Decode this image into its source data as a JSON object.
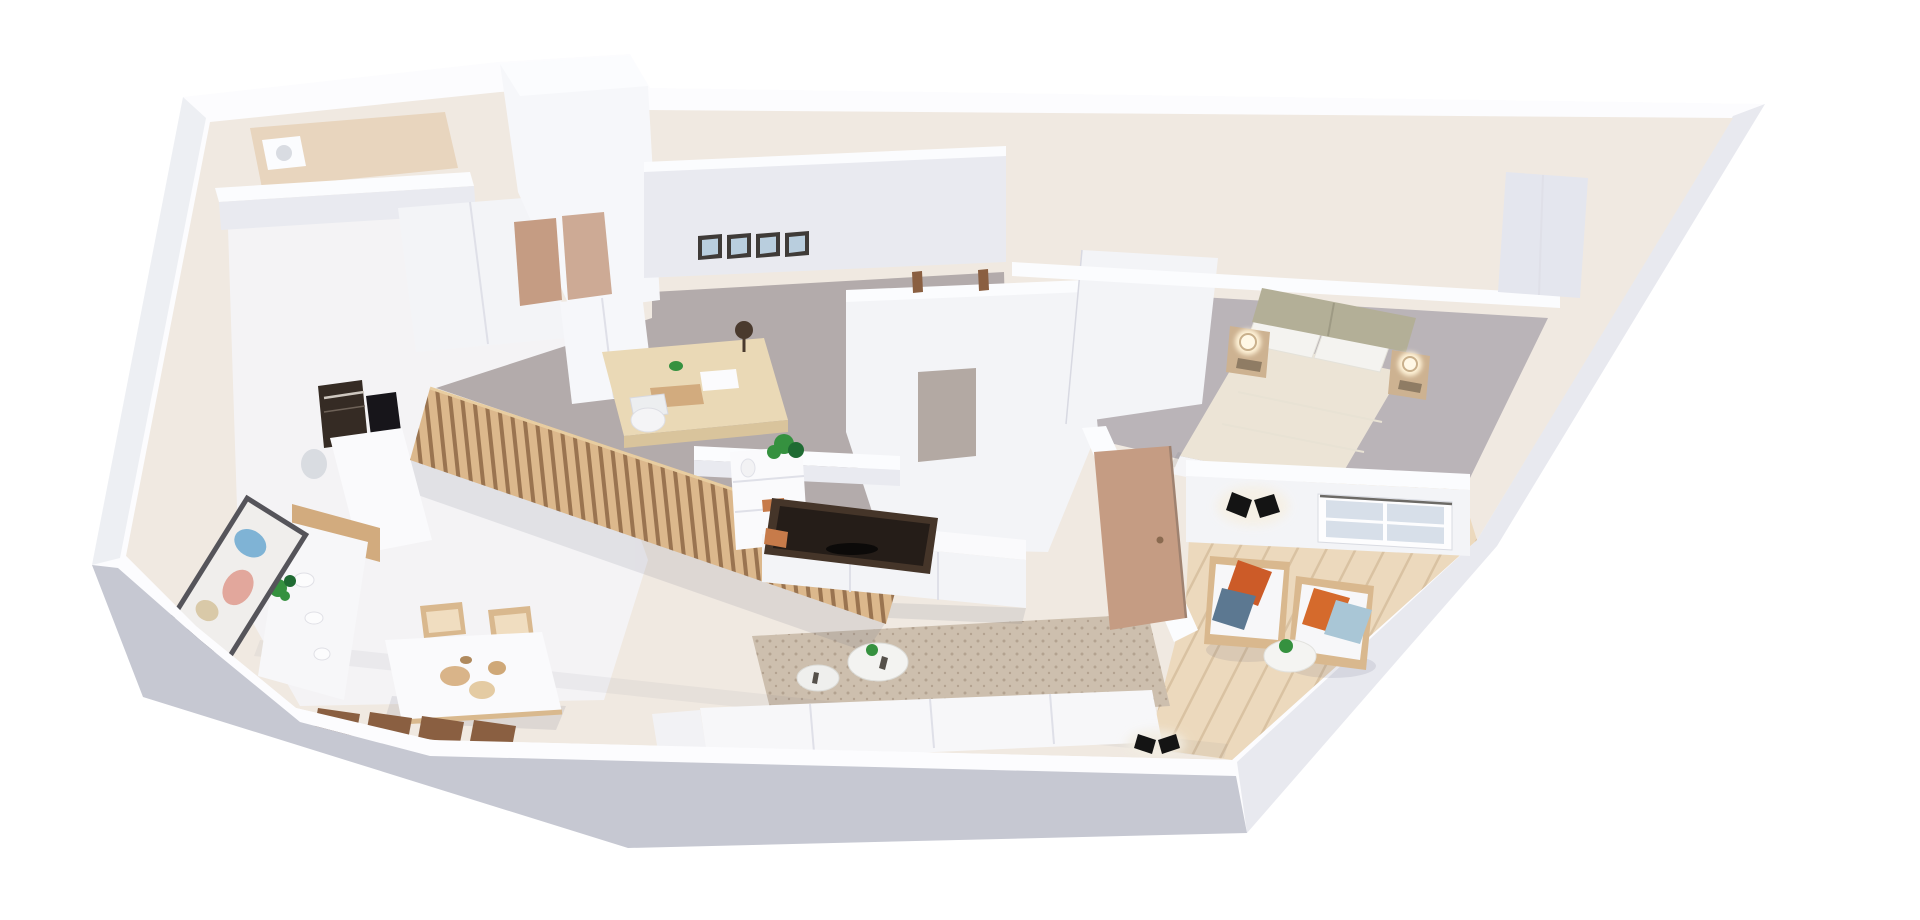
{
  "scene": {
    "type": "3d-floor-plan-render",
    "view": "isometric-top-down",
    "background": "plain white, no text or UI chrome",
    "description": "Photorealistic 3D render of a one-bedroom apartment floor plan seen from above at an angle; white cut walls, wedge-shaped footprint widening to the right",
    "rooms": [
      {
        "id": "bathroom",
        "label": "Bathroom (top-left)",
        "furniture": [
          "washer unit"
        ]
      },
      {
        "id": "kitchen-dining",
        "label": "Kitchen and dining area",
        "furniture": [
          "white cabinet columns",
          "built-in dark oven",
          "black cooktop",
          "marble counters",
          "wood plinth",
          "glass vase",
          "framed wall artwork",
          "potted plant",
          "white bowls",
          "dining table",
          "two light wood chairs",
          "four dark wood chairs"
        ]
      },
      {
        "id": "study",
        "label": "Study / office",
        "furniture": [
          "white wardrobes",
          "four framed wall pictures",
          "desk with lamp and papers",
          "white desk chair",
          "vertical wood slat partition",
          "white shelf unit with monstera plant and books"
        ]
      },
      {
        "id": "living-room",
        "label": "Living room",
        "furniture": [
          "white TV console",
          "dark TV panel",
          "speckled beige rug",
          "large round coffee table",
          "small round coffee table",
          "white sofa"
        ]
      },
      {
        "id": "hallway",
        "label": "Hallway",
        "furniture": [
          "open wood door",
          "shadowed doorway",
          "door knobs on wall top"
        ]
      },
      {
        "id": "bedroom",
        "label": "Bedroom",
        "furniture": [
          "double bed with sage upholstered headboard",
          "two white pillows",
          "cream duvet",
          "floating wood nightstand left with glowing lamp",
          "floating wood nightstand right with glowing lamp",
          "closet niche"
        ]
      },
      {
        "id": "terrace-lounge",
        "label": "Lounge corner / terrace",
        "furniture": [
          "wicker armchair left",
          "wicker armchair right",
          "orange pillows",
          "blue-gray pillow",
          "light blue pillow",
          "round white side table",
          "small green plant",
          "window in wall",
          "black wall sconce upper",
          "black wall sconce lower"
        ]
      }
    ]
  },
  "colors": {
    "background": "#ffffff",
    "shell_white": "#fcfcfe",
    "wall_face": "#e9eaf0",
    "wall_face_light": "#f3f4f7",
    "front_wall_shadow": "#c6c8d2",
    "right_wall_face": "#e8e9ef",
    "left_wall_face": "#edeff3",
    "floor_base": "#f0e9e1",
    "floor_kitchen": "#f4f3f5",
    "floor_bath": "#e8d5be",
    "carpet_study": "#b3abab",
    "carpet_bedroom": "#bab4b8",
    "terrace_wood": "#ecd9bd",
    "terrace_plank_line": "#d9c2a2",
    "rug_base": "#cdbfae",
    "rug_dot": "#b3a290",
    "slat_wood": "#dcb88c",
    "slat_gap": "#9a7450",
    "furniture_wood": "#d9b88e",
    "chair_dark_wood": "#8a5f41",
    "door_wood": "#c59c83",
    "cabinet_wood": "#d2ab7e",
    "desk_wood": "#ead9b6",
    "desk_edge": "#d9c49c",
    "appliance_dark": "#352b24",
    "appliance_black": "#17151a",
    "tv_brown": "#453529",
    "tv_screen": "#251d18",
    "copper_deco": "#c77b4a",
    "sofa_white": "#f7f7f9",
    "table_white": "#fafafc",
    "headboard_sage": "#b3af97",
    "duvet_cream": "#ece4d6",
    "pillow_white": "#f4f3f0",
    "pillow_orange": "#cc5b28",
    "pillow_orange_light": "#d56a2c",
    "pillow_blue_gray": "#5c7891",
    "pillow_blue_light": "#a9c6d6",
    "plant_green": "#35913f",
    "plant_dark": "#1f6b33",
    "lamp_glow": "#fff3d8",
    "nightstand_wood": "#cdb291",
    "sconce_black": "#141414",
    "frame_dark": "#3f3b38",
    "frame_glass": "#b9cede",
    "window_glass": "#d7dfe9",
    "art_frame": "#55545a",
    "art_blue": "#7fb3d5",
    "art_pink": "#e2a79c",
    "art_sand": "#d9c9a8",
    "doorway_shadow": "#b3a9a3",
    "bowl_tan": "#d9b489",
    "bowl_tan_light": "#e4cba3",
    "bowl_tan_dark": "#cfa878",
    "shadow": "#5c5f77"
  }
}
